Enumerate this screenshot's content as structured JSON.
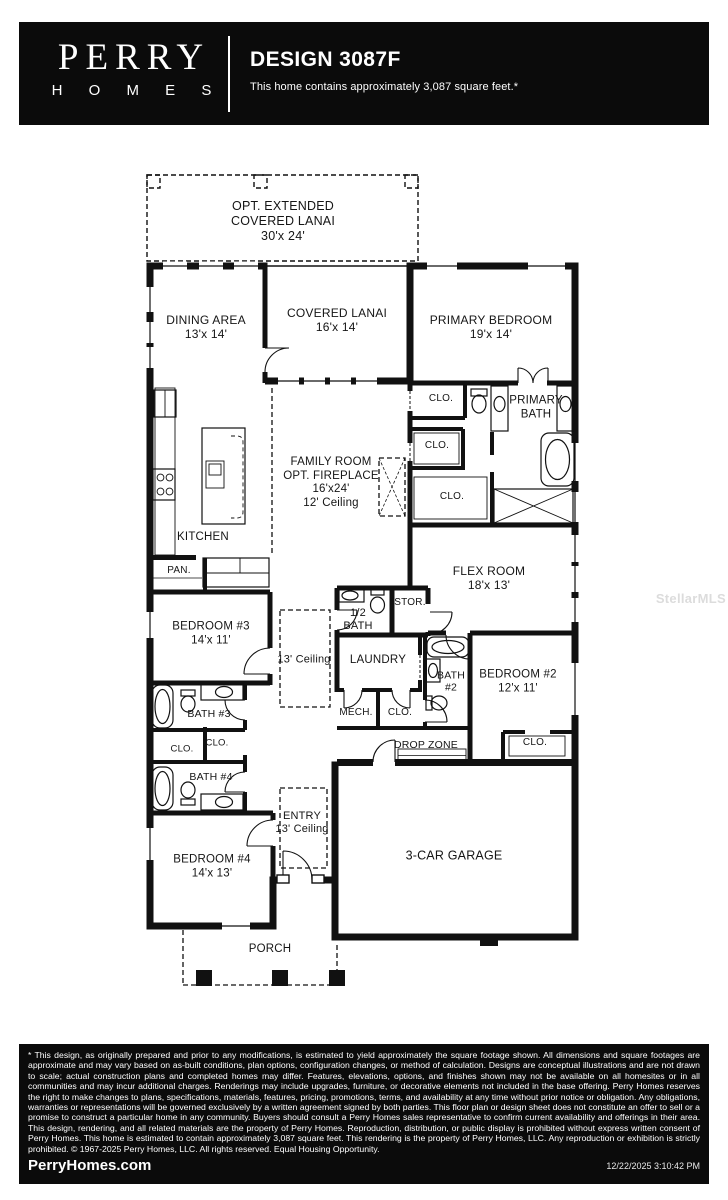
{
  "header": {
    "brand_top": "PERRY",
    "brand_bottom": "H O M E S",
    "title": "DESIGN 3087F",
    "subtitle": "This home contains approximately 3,087 square feet.*"
  },
  "floor_plan": {
    "watermark": "StellarMLS",
    "labels": {
      "opt_lanai": "OPT. EXTENDED\nCOVERED LANAI\n30'x 24'",
      "dining": "DINING AREA\n13'x 14'",
      "covered_lanai": "COVERED LANAI\n16'x 14'",
      "primary_bedroom": "PRIMARY BEDROOM\n19'x 14'",
      "clo_primary_entry": "CLO.",
      "primary_bath": "PRIMARY\nBATH",
      "clo_primary_mid": "CLO.",
      "clo_primary_large": "CLO.",
      "family_room": "FAMILY ROOM\nOPT. FIREPLACE\n16'x24'\n12' Ceiling",
      "kitchen": "KITCHEN",
      "pantry": "PAN.",
      "flex_room": "FLEX ROOM\n18'x 13'",
      "bedroom3": "BEDROOM #3\n14'x 11'",
      "half_bath": "1/2\nBATH",
      "storage": "STOR.",
      "hall_ceiling": "13' Ceiling",
      "laundry": "LAUNDRY",
      "bath2": "BATH\n#2",
      "bedroom2": "BEDROOM #2\n12'x 11'",
      "bath3": "BATH #3",
      "clo_bed3_a": "CLO.",
      "clo_bed3_b": "CLO.",
      "mech": "MECH.",
      "clo_hall": "CLO.",
      "drop_zone": "DROP ZONE",
      "clo_bed2": "CLO.",
      "bath4": "BATH #4",
      "bedroom4": "BEDROOM #4\n14'x 13'",
      "entry": "ENTRY\n13' Ceiling",
      "garage": "3-CAR GARAGE",
      "porch": "PORCH"
    }
  },
  "footer": {
    "disclaimer": "* This design, as originally prepared and prior to any modifications, is estimated to yield approximately the square footage shown. All dimensions and square footages are approximate and may vary based on as-built conditions, plan options, configuration changes, or method of calculation. Designs are conceptual illustrations and are not drawn to scale; actual construction plans and completed homes may differ. Features, elevations, options, and finishes shown may not be available on all homesites or in all communities and may incur additional charges. Renderings may include upgrades, furniture, or decorative elements not included in the base offering. Perry Homes reserves the right to make changes to plans, specifications, materials, features, pricing, promotions, terms, and availability at any time without prior notice or obligation. Any obligations, warranties or representations will be governed exclusively by a written agreement signed by both parties. This floor plan or design sheet does not constitute an offer to sell or a promise to construct a particular home in any community. Buyers should consult a Perry Homes sales representative to confirm current availability and offerings in their area. This design, rendering, and all related materials are the property of Perry Homes. Reproduction, distribution, or public display is prohibited without express written consent of Perry Homes. This home is estimated to contain approximately 3,087 square feet. This rendering is the property of Perry Homes, LLC. Any reproduction or exhibition is strictly prohibited. © 1967-2025 Perry Homes, LLC. All rights reserved. Equal Housing Opportunity.",
    "website": "PerryHomes.com",
    "timestamp": "12/22/2025 3:10:42 PM"
  },
  "colors": {
    "bar_bg": "#0b0b0b",
    "wall": "#111111",
    "watermark": "#dcdcdc"
  }
}
